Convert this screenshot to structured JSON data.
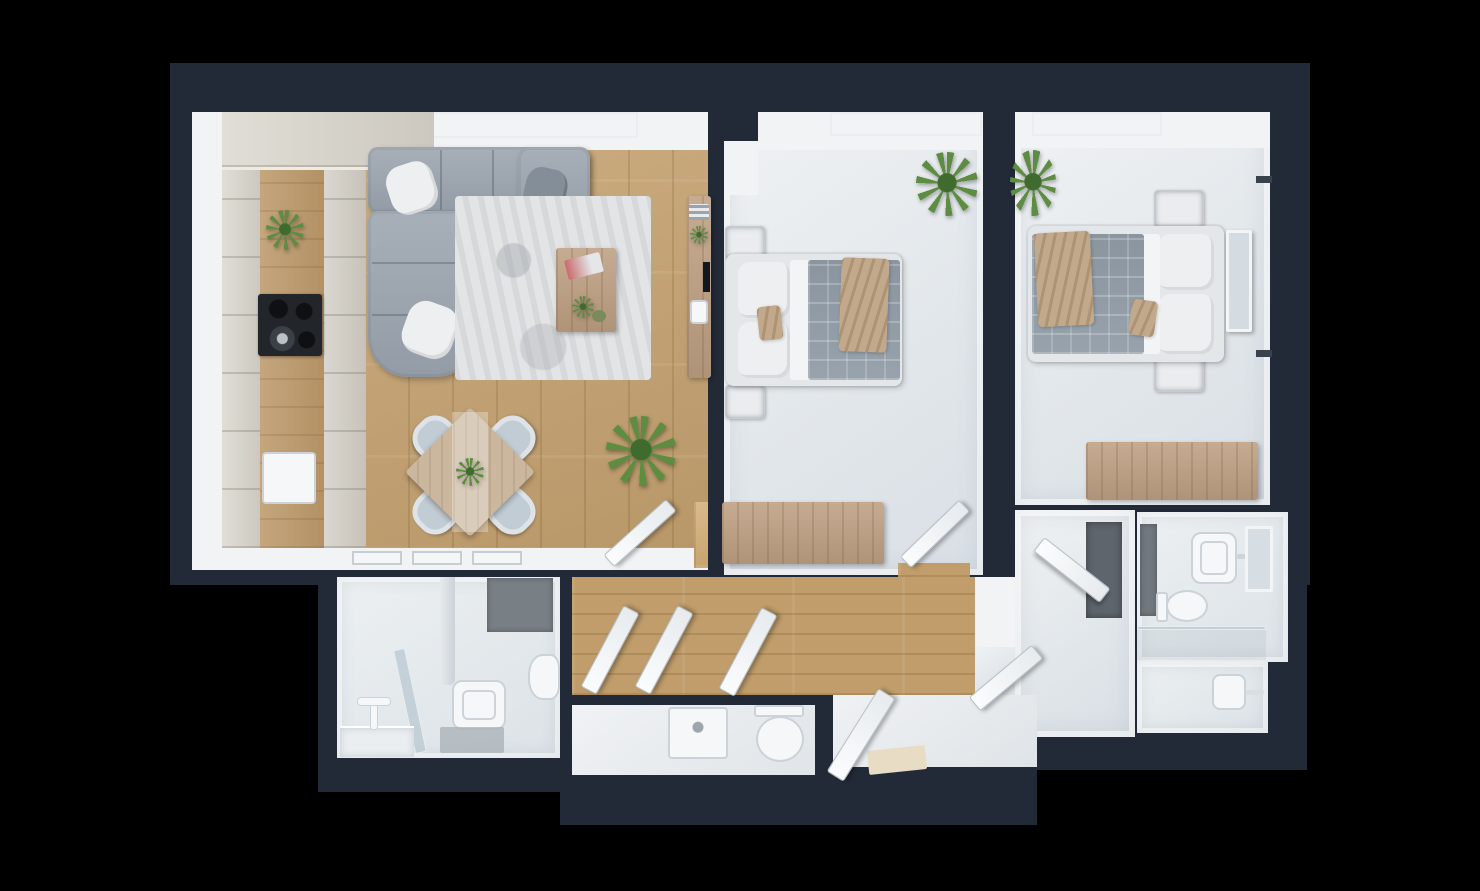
{
  "scene": {
    "type": "3d-floor-plan",
    "description": "Photorealistic top-down dollhouse render of a two-bedroom apartment on a black background",
    "background_color": "#000000",
    "no_visible_text": true
  },
  "colors": {
    "wall": "#232A37",
    "band": "#F1F3F5",
    "wood": "#C5A372",
    "wood_hall": "#C09D6B",
    "counter": "#BD9A6B",
    "cabinet": "#D7D3C9",
    "sofa": "#9AA3AD",
    "pillow": "#EDEFF1",
    "rug": "#E3E4E5",
    "chair": "#C2CCD4",
    "table_wood": "#CBB69E",
    "blanket": "#929DA8",
    "throw": "#C2A98C",
    "furn_wood": "#BEA083",
    "plant": "#5D8D41",
    "plant_dark": "#3F6B2E",
    "tile_dark": "#71787E",
    "mat_gray": "#A8B0B5",
    "entry_mat": "#E8DCC5",
    "cooktop": "#22262A",
    "wardrobe_dark": "#5E656C"
  },
  "rooms": [
    {
      "id": "living-room-kitchen",
      "name": "Living room with open kitchen",
      "floor": "light oak planks",
      "furniture": [
        "L-shaped gray corner sofa with three pillows",
        "mottled gray area rug",
        "wooden coffee table with books and plants",
        "rotated square dining table with plant centerpiece",
        "four upholstered dining chairs",
        "tall kitchen cabinet run with wooden worktop",
        "black cooktop with pot",
        "built-in white appliance",
        "wall sideboard with TV and decor",
        "large potted palm",
        "window band at top",
        "open interior door to hallway"
      ]
    },
    {
      "id": "bedroom-1",
      "name": "Middle bedroom",
      "floor": "light gray",
      "furniture": [
        "double bed with white linen, gray plaid duvet and beige throw",
        "two nightstands",
        "wooden blanket chest at foot wall",
        "potted plant",
        "window band",
        "open door to hallway"
      ]
    },
    {
      "id": "bedroom-2",
      "name": "Right bedroom",
      "floor": "light gray",
      "furniture": [
        "double bed with white linen, gray plaid duvet and beige throw",
        "two nightstands",
        "leaning floor mirror",
        "wooden dresser/desk",
        "potted plant",
        "window band",
        "two wall handles"
      ]
    },
    {
      "id": "hallway",
      "name": "Hallway",
      "floor": "oak planks",
      "furniture": [
        "three open white doors leaning into corridor",
        "open door toward wardrobe corridor"
      ]
    },
    {
      "id": "wc-laundry",
      "name": "WC / laundry room",
      "floor": "white",
      "furniture": [
        "washing machine / cabinet",
        "toilet"
      ]
    },
    {
      "id": "bathroom-left",
      "name": "Bathroom (bottom left)",
      "floor": "white",
      "furniture": [
        "walk-in shower with glass screen and riser pipe",
        "washbasin",
        "toilet",
        "dark wall-mounted towel panel",
        "gray bath mat"
      ]
    },
    {
      "id": "bathroom-right",
      "name": "Bathroom (bottom right)",
      "floor": "white",
      "furniture": [
        "washbasin with faucet",
        "wall mirror",
        "toilet",
        "dark accent tile strip",
        "shower area behind glass",
        "small basin / bidet with rail"
      ]
    },
    {
      "id": "entry",
      "name": "Entry",
      "floor": "white",
      "furniture": [
        "open entrance door",
        "beige doormat"
      ]
    },
    {
      "id": "wardrobe-corridor",
      "name": "Wardrobe corridor",
      "floor": "white",
      "furniture": [
        "built-in wardrobe with dark front",
        "open door"
      ]
    }
  ]
}
